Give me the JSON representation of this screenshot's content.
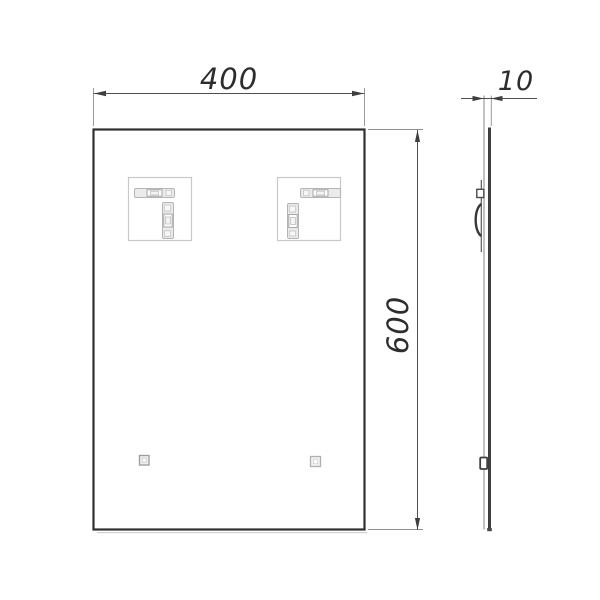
{
  "front_view": {
    "width_dimension": "400",
    "height_dimension": "600"
  },
  "side_view": {
    "thickness_dimension": "10"
  },
  "colors": {
    "background": "#ffffff",
    "outline": "#303030",
    "dimension_lines": "#4f4f4f",
    "dimension_text": "#2d2d2d",
    "light_details": "#c8c8c8"
  }
}
